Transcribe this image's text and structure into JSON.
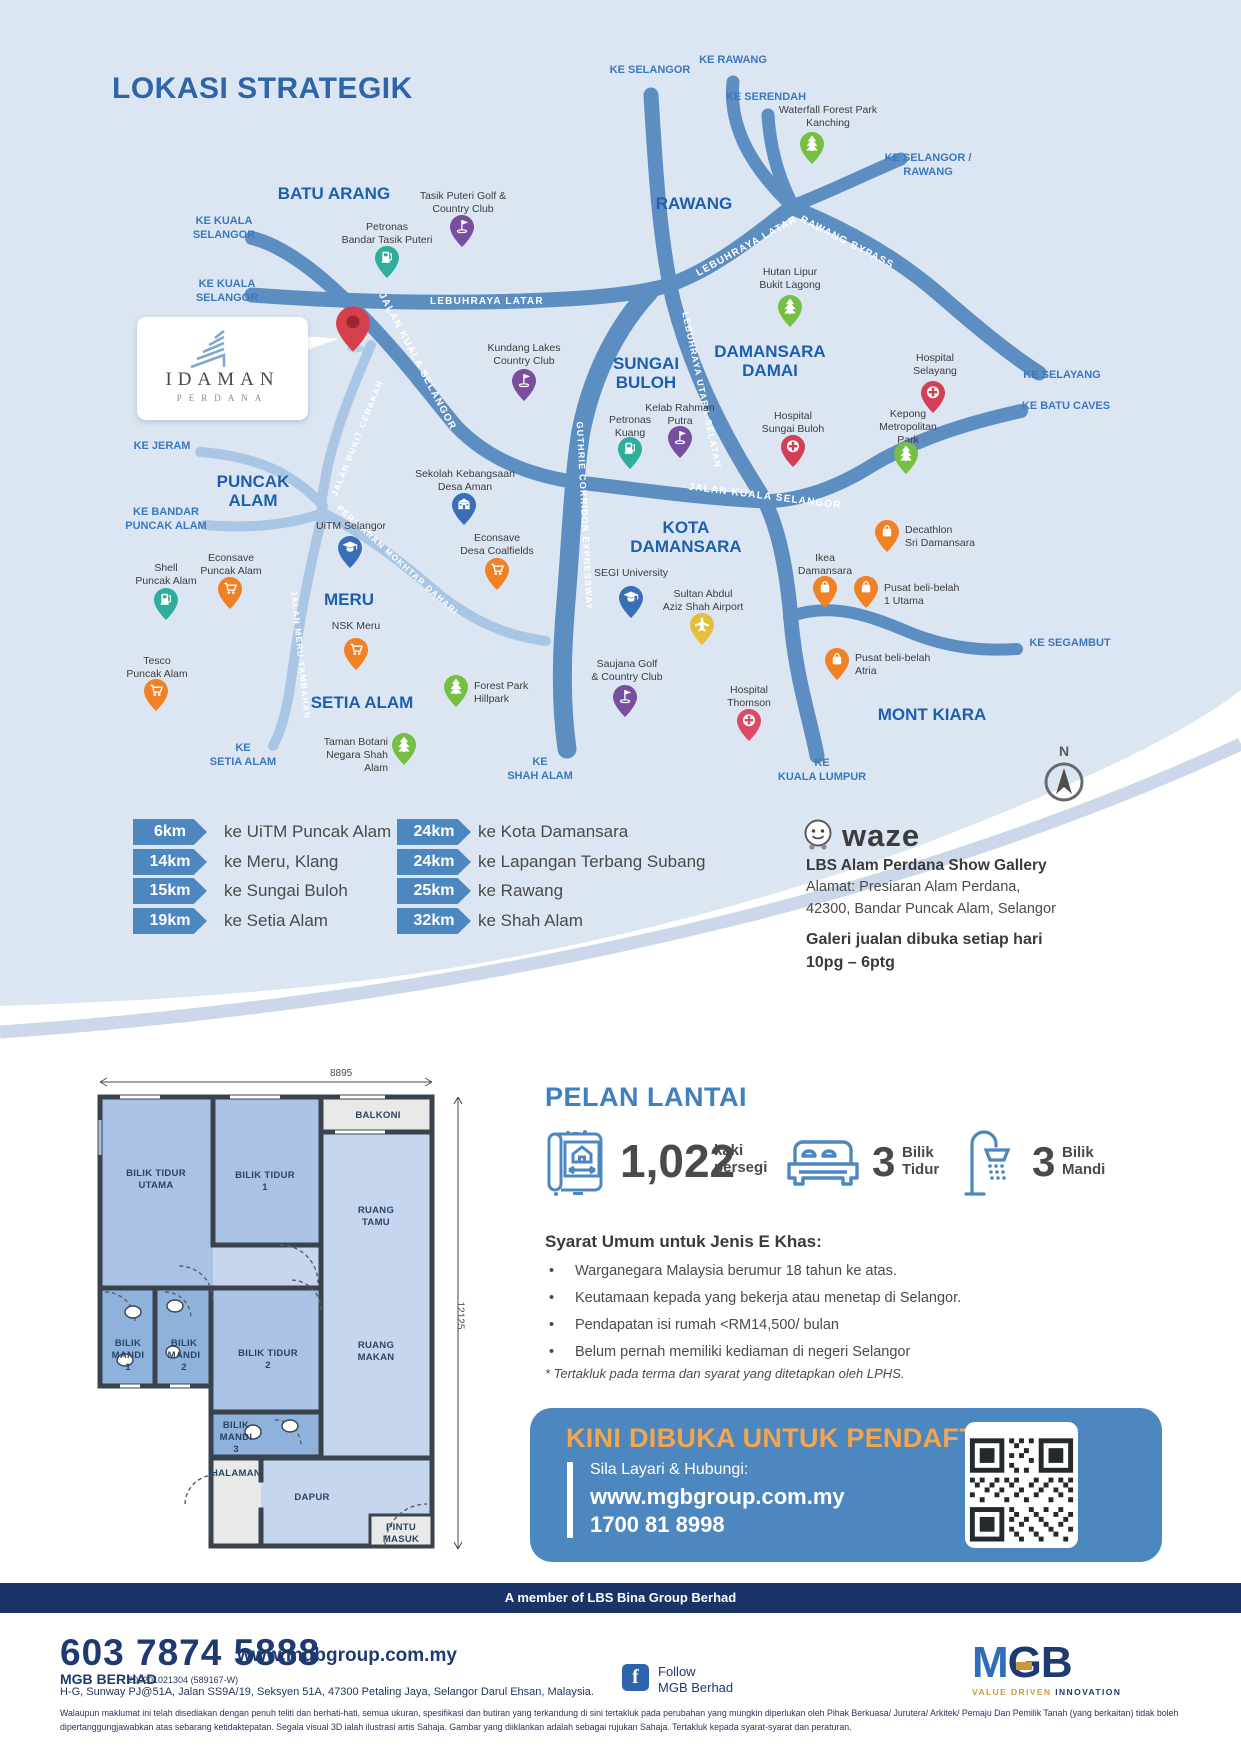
{
  "colors": {
    "map_bg": "#dce6f2",
    "road_major": "#5d8ec2",
    "road_minor": "#a9c6e4",
    "label_blue": "#1d5fae",
    "accent_blue": "#4d87c0",
    "banner_orange": "#f3a64d",
    "navy": "#1b3467",
    "gold": "#c99a3d",
    "pin_red": "#d6404d",
    "pin_purple": "#7a4e9f",
    "pin_green": "#76bf43",
    "pin_teal": "#2fae9b",
    "pin_orange": "#f08124",
    "pin_blue": "#3a6fb8",
    "pin_yellow": "#e4c03a",
    "pin_hospital": "#d23f56"
  },
  "map": {
    "title": "LOKASI STRATEGIK",
    "compass": "N",
    "logo": {
      "line1": "IDAMAN",
      "line2": "PERDANA"
    },
    "areas": [
      "BATU ARANG",
      "RAWANG",
      "SUNGAI\nBULOH",
      "DAMANSARA\nDAMAI",
      "PUNCAK\nALAM",
      "KOTA\nDAMANSARA",
      "MERU",
      "SETIA ALAM",
      "MONT KIARA"
    ],
    "directions": [
      "KE KUALA\nSELANGOR",
      "KE KUALA\nSELANGOR",
      "KE SELANGOR",
      "KE RAWANG",
      "KE SERENDAH",
      "KE SELANGOR /\nRAWANG",
      "KE SELAYANG",
      "KE BATU CAVES",
      "KE SEGAMBUT",
      "KE JERAM",
      "KE BANDAR\nPUNCAK ALAM",
      "KE\nSETIA ALAM",
      "KE\nSHAH ALAM",
      "KE\nKUALA LUMPUR"
    ],
    "roads": [
      "LEBUHRAYA LATAR",
      "LEBUHRAYA LATAR",
      "RAWANG BYPASS",
      "JALAN KUALA SELANGOR",
      "JALAN KUALA SELANGOR",
      "LEBUHRAYA UTARA-SELATAN",
      "GUTHRIE CORRIDOR EXPRESSWAY",
      "JALAN BUKIT CERAKAH",
      "PERSIARAN MOKHTAR DAHARI",
      "JALAN MERU TAMBAHAN"
    ],
    "pois": [
      {
        "label": "Tasik Puteri Golf &\nCountry Club",
        "type": "golf"
      },
      {
        "label": "Petronas\nBandar Tasik Puteri",
        "type": "fuel"
      },
      {
        "label": "Waterfall Forest Park\nKanching",
        "type": "park"
      },
      {
        "label": "Hutan Lipur\nBukit Lagong",
        "type": "park"
      },
      {
        "label": "Hospital\nSelayang",
        "type": "hospital"
      },
      {
        "label": "Kepong\nMetropolitan\nPark",
        "type": "park"
      },
      {
        "label": "Kundang Lakes\nCountry Club",
        "type": "golf"
      },
      {
        "label": "Petronas\nKuang",
        "type": "fuel"
      },
      {
        "label": "Kelab Rahman\nPutra",
        "type": "golf"
      },
      {
        "label": "Hospital\nSungai Buloh",
        "type": "hospital"
      },
      {
        "label": "Sekolah Kebangsaan\nDesa Aman",
        "type": "school"
      },
      {
        "label": "Econsave\nDesa Coalfields",
        "type": "shop"
      },
      {
        "label": "UiTM Selangor",
        "type": "university"
      },
      {
        "label": "Shell\nPuncak Alam",
        "type": "fuel"
      },
      {
        "label": "Econsave\nPuncak Alam",
        "type": "shop"
      },
      {
        "label": "NSK Meru",
        "type": "shop"
      },
      {
        "label": "Tesco\nPuncak Alam",
        "type": "shop"
      },
      {
        "label": "SEGI University",
        "type": "university"
      },
      {
        "label": "Sultan Abdul\nAziz Shah Airport",
        "type": "airport"
      },
      {
        "label": "Saujana Golf\n& Country Club",
        "type": "golf"
      },
      {
        "label": "Forest Park\nHillpark",
        "type": "park"
      },
      {
        "label": "Taman Botani\nNegara Shah Alam",
        "type": "park"
      },
      {
        "label": "Hospital\nThomson",
        "type": "hospital"
      },
      {
        "label": "Decathlon\nSri Damansara",
        "type": "mall"
      },
      {
        "label": "Ikea\nDamansara",
        "type": "mall"
      },
      {
        "label": "Pusat beli-belah\n1 Utama",
        "type": "mall"
      },
      {
        "label": "Pusat beli-belah\nAtria",
        "type": "mall"
      }
    ]
  },
  "distances": {
    "left": [
      {
        "km": "6km",
        "dest": "ke UiTM Puncak Alam"
      },
      {
        "km": "14km",
        "dest": "ke Meru, Klang"
      },
      {
        "km": "15km",
        "dest": "ke Sungai Buloh"
      },
      {
        "km": "19km",
        "dest": "ke Setia Alam"
      }
    ],
    "right": [
      {
        "km": "24km",
        "dest": "ke Kota Damansara"
      },
      {
        "km": "24km",
        "dest": "ke Lapangan Terbang Subang"
      },
      {
        "km": "25km",
        "dest": "ke Rawang"
      },
      {
        "km": "32km",
        "dest": "ke Shah Alam"
      }
    ]
  },
  "waze": {
    "brand": "waze",
    "gallery": "LBS Alam Perdana Show Gallery",
    "address_line1": "Alamat: Presiaran Alam Perdana,",
    "address_line2": "42300, Bandar Puncak Alam, Selangor",
    "hours_line1": "Galeri jualan dibuka setiap hari",
    "hours_line2": "10pg – 6ptg"
  },
  "floorplan": {
    "heading": "PELAN LANTAI",
    "dim_width": "8895",
    "dim_height": "12125",
    "rooms": [
      "BILIK TIDUR\nUTAMA",
      "BILIK TIDUR\n1",
      "BALKONI",
      "RUANG\nTAMU",
      "BILIK\nMANDI\n1",
      "BILIK\nMANDI\n2",
      "BILIK TIDUR\n2",
      "RUANG\nMAKAN",
      "BILIK\nMANDI\n3",
      "HALAMAN",
      "DAPUR",
      "PINTU\nMASUK"
    ],
    "stats": [
      {
        "value": "1,022",
        "unit": "kaki\npersegi"
      },
      {
        "value": "3",
        "unit": "Bilik\nTidur"
      },
      {
        "value": "3",
        "unit": "Bilik\nMandi"
      }
    ],
    "terms_title": "Syarat Umum untuk Jenis E Khas:",
    "terms": [
      "Warganegara Malaysia berumur 18 tahun ke atas.",
      "Keutamaan kepada yang bekerja atau menetap di Selangor.",
      "Pendapatan isi rumah <RM14,500/ bulan",
      "Belum pernah memiliki kediaman di negeri Selangor"
    ],
    "note": "* Tertakluk pada terma dan syarat yang ditetapkan oleh LPHS."
  },
  "registration": {
    "headline": "KINI DIBUKA UNTUK PENDAFTARAN",
    "cta": "Sila Layari & Hubungi:",
    "website": "www.mgbgroup.com.my",
    "phone": "1700 81 8998"
  },
  "member_bar": "A member of LBS Bina Group Berhad",
  "footer": {
    "phone": "603 7874 5888",
    "website": "www.mgbgroup.com.my",
    "company": "MGB BERHAD",
    "reg_no": "200201021304 (589167-W)",
    "address": "H-G, Sunway PJ@51A, Jalan SS9A/19, Seksyen 51A, 47300 Petaling Jaya, Selangor Darul Ehsan, Malaysia.",
    "follow_line1": "Follow",
    "follow_line2": "MGB Berhad",
    "logo_m": "M",
    "logo_g": "G",
    "logo_b": "B",
    "tagline_gold": "VALUE DRIVEN",
    "tagline_navy": "INNOVATION",
    "disclaimer": "Walaupun maklumat ini telah disediakan dengan penuh teliti dan berhati-hati, semua ukuran, spesifikasi dan butiran yang terkandung di sini tertakluk pada perubahan yang mungkin diperlukan oleh Pihak Berkuasa/ Jurutera/ Arkitek/ Pemaju Dan Pemilik Tanah (yang berkaitan) tidak boleh dipertanggungjawabkan atas sebarang ketidaktepatan. Segala visual 3D ialah ilustrasi artis Sahaja. Gambar yang diiklankan adalah sebagai rujukan Sahaja. Tertakluk kepada syarat-syarat dan peraturan."
  }
}
